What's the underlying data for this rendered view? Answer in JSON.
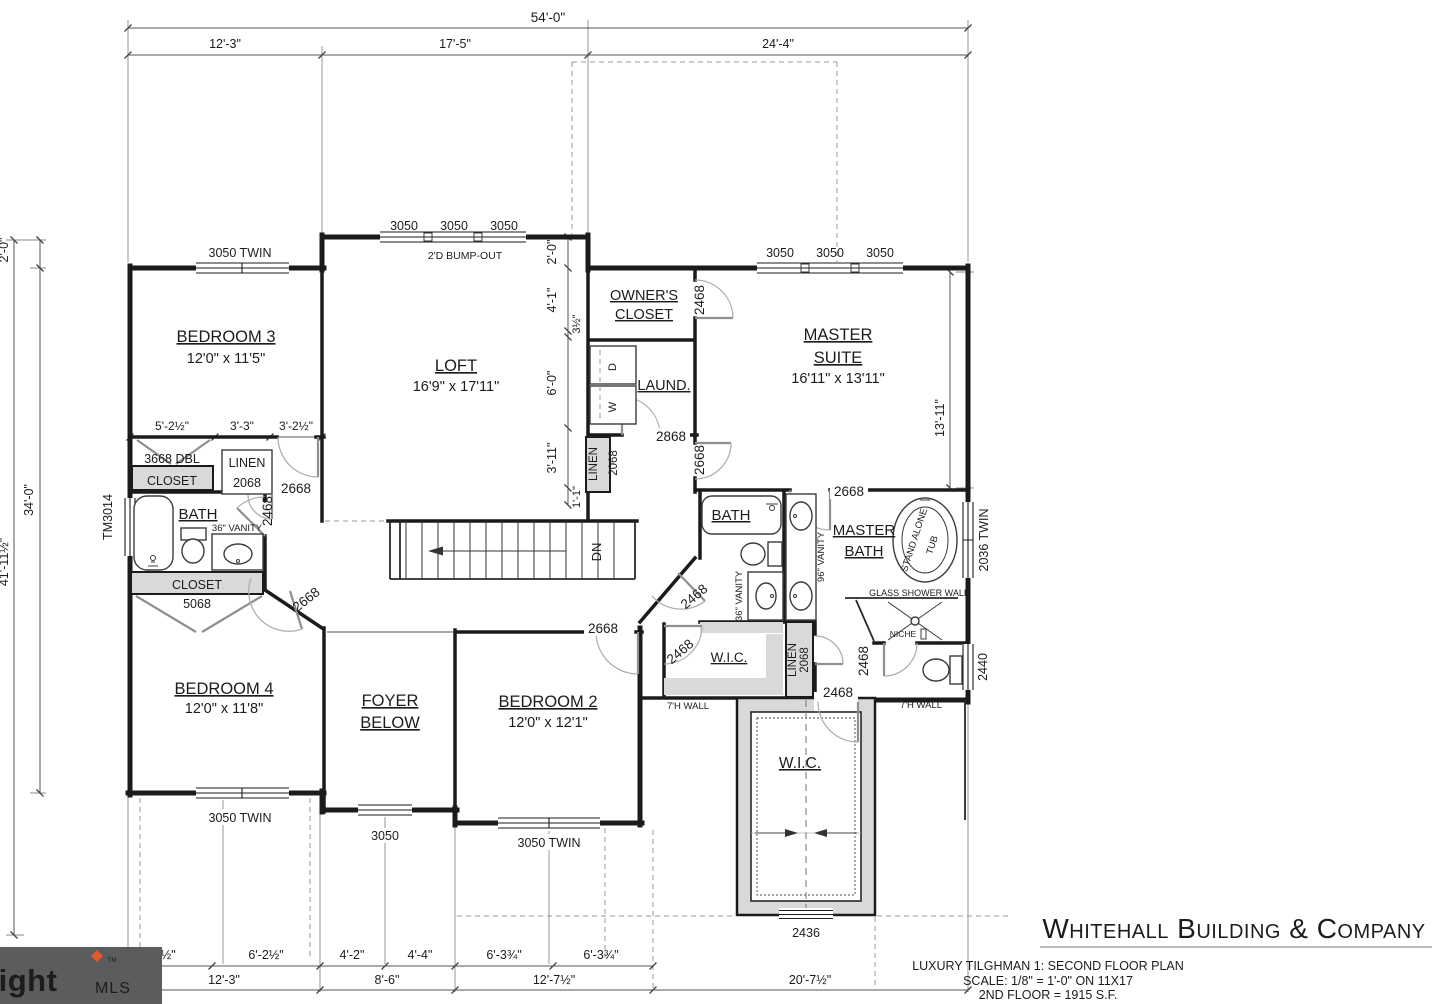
{
  "colors": {
    "wall": "#1b1b1b",
    "shade": "#d9d9d9",
    "door_swing": "#909090",
    "watermark_bg": "#5a5c5e",
    "watermark_accent": "#e2592f",
    "logo_text": "#6d7174"
  },
  "dims": {
    "top": [
      "54'-0\"",
      "12'-3\"",
      "17'-5\"",
      "24'-4\""
    ],
    "left": [
      "2'-0\"",
      "34'-0\"",
      "41'-11½\""
    ],
    "right": [
      "13'-11\""
    ],
    "loft_chain": [
      "2'-0\"",
      "4'-1\"",
      "3½\"",
      "6'-0\"",
      "3'-11\"",
      "1'-1\""
    ],
    "closet_chain": [
      "5'-2½\"",
      "3'-3\"",
      "3'-2½\""
    ],
    "bottom_upper": [
      "6'-0½\"",
      "6'-2½\"",
      "4'-2\"",
      "4'-4\"",
      "6'-3¾\"",
      "6'-3¾\""
    ],
    "bottom_lower": [
      "12'-3\"",
      "8'-6\"",
      "12'-7½\"",
      "20'-7½\""
    ]
  },
  "windows": {
    "bed3": "3050 TWIN",
    "loft": [
      "3050",
      "3050",
      "3050"
    ],
    "master": [
      "3050",
      "3050",
      "3050"
    ],
    "left_bath": "TM3014",
    "master_bath": "2036 TWIN",
    "toilet": "2440",
    "bed4": "3050 TWIN",
    "foyer": "3050",
    "bed2": "3050 TWIN",
    "wic": "2436"
  },
  "doors": {
    "owners_closet": "2468",
    "laundry": "2868",
    "master_suite": "2668",
    "bed3": "2668",
    "bath_left": "2468",
    "bed4": "2668",
    "bed2": "2668",
    "master_bath": "2668",
    "bath_hall": "2468",
    "wic_bed2": "2468",
    "wic_master": "2468",
    "toilet": "2468"
  },
  "rooms": {
    "bed3": {
      "name": "BEDROOM 3",
      "size": "12'0\" x 11'5\""
    },
    "loft": {
      "name": "LOFT",
      "size": "16'9\" x 17'11\""
    },
    "owners_closet": {
      "l1": "OWNER'S",
      "l2": "CLOSET"
    },
    "master": {
      "l1": "MASTER",
      "l2": "SUITE",
      "size": "16'11\" x 13'11\""
    },
    "laundry": {
      "name": "LAUND."
    },
    "bath_left": {
      "name": "BATH"
    },
    "bath_hall": {
      "name": "BATH"
    },
    "master_bath": {
      "l1": "MASTER",
      "l2": "BATH"
    },
    "bed4": {
      "name": "BEDROOM 4",
      "size": "12'0\" x 11'8\""
    },
    "foyer": {
      "l1": "FOYER",
      "l2": "BELOW"
    },
    "bed2": {
      "name": "BEDROOM 2",
      "size": "12'0\" x 12'1\""
    },
    "wic_bed2": {
      "name": "W.I.C."
    },
    "wic_master": {
      "name": "W.I.C."
    }
  },
  "closets": {
    "dbl": {
      "l1": "3668 DBL",
      "l2": "CLOSET"
    },
    "linen_bath": {
      "l1": "LINEN",
      "l2": "2068"
    },
    "linen_stairs": {
      "l1": "LINEN",
      "l2": "2068"
    },
    "linen_hall": {
      "l1": "LINEN",
      "l2": "2068"
    },
    "c5068": {
      "l1": "CLOSET",
      "l2": "5068"
    }
  },
  "annotations": {
    "bump_out": "2'D BUMP-OUT",
    "vanity36_left": "36\" VANITY",
    "vanity36_hall": "36\" VANITY",
    "vanity96": "96\" VANITY",
    "tub_l1": "STAND ALONE",
    "tub_l2": "TUB",
    "glass_wall": "GLASS SHOWER WALL",
    "niche": "NICHE",
    "wall7_left": "7'H WALL",
    "wall7_right": "7'H WALL",
    "dn": "DN",
    "dryer": "D",
    "washer": "W"
  },
  "title_block": {
    "company": "Whitehall Building & Company",
    "plan": "LUXURY TILGHMAN 1: SECOND FLOOR PLAN",
    "scale": "SCALE: 1/8\" = 1'-0\" ON 11X17",
    "area": "2ND FLOOR = 1915 S.F."
  },
  "watermark": {
    "brand": "bright",
    "tm": "TM",
    "suffix": "MLS"
  }
}
